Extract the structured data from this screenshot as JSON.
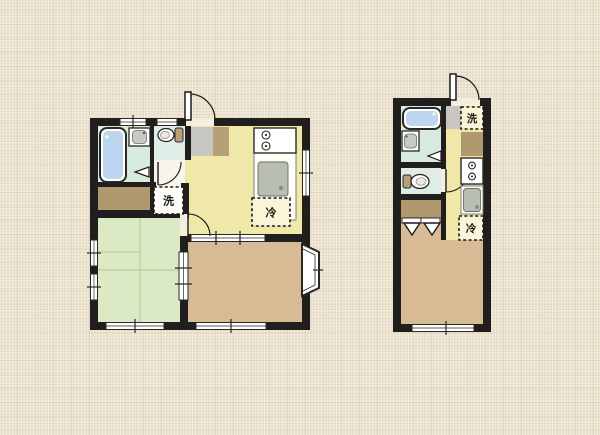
{
  "document": {
    "type": "apartment-floor-plans",
    "plan_count": 2
  },
  "labels": {
    "washer": "洗",
    "fridge": "冷"
  },
  "colors": {
    "wall": "#211f1d",
    "kitchen": "#f0e8a9",
    "tatami": "#dce9c5",
    "wood": "#d8ba95",
    "bath": "#d8ebdf",
    "toilet_floor": "#deeee7",
    "closet": "#b0986f",
    "genkan": "#c7c6c0",
    "step": "#b5a078",
    "hall": "#f7f4ec",
    "fixture": "#ffffff",
    "water": "#bcd6ef",
    "sink_gray": "#b9beb2",
    "label_bg": "#faf4d8",
    "label_text": "#1c1a18"
  }
}
